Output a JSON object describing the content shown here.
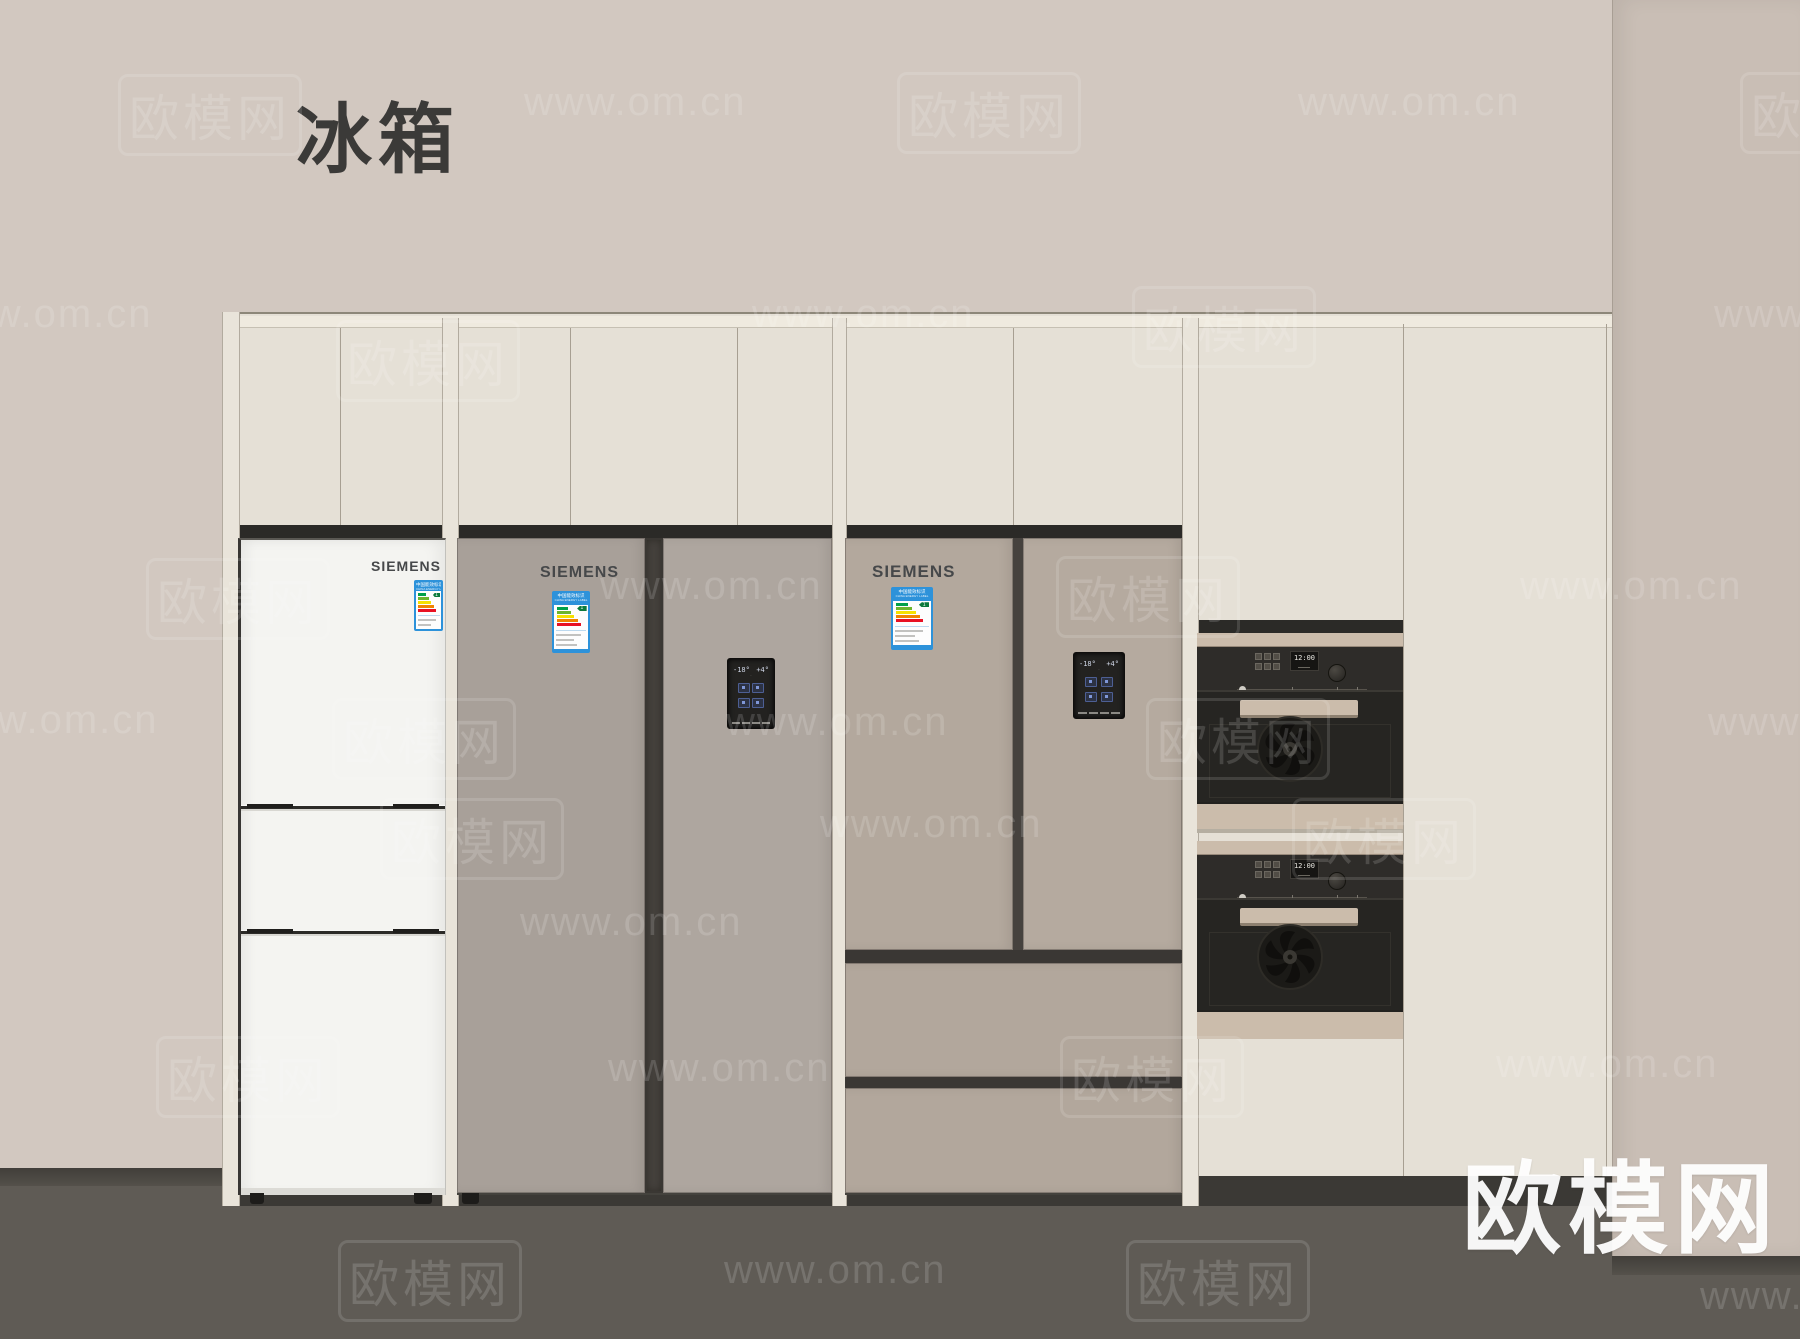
{
  "title": "冰箱",
  "site_logo": "欧模网",
  "watermark_url": "www.om.cn",
  "watermark_brand": "欧模网",
  "colors": {
    "wall": "#d2c8c0",
    "right_wall": "#c9beb5",
    "floor": "#5f5b55",
    "cabinet": "#e5e0d6",
    "fridge_white": "#f4f4f1",
    "fridge_gray": "#a8a099",
    "fridge_taupe": "#b3a89d",
    "label_blue": "#2d92da",
    "oven_trim": "#cbbcab",
    "oven_black": "#2e2c29"
  },
  "fridges": [
    {
      "brand": "SIEMENS",
      "type": "three-door bottom freezer"
    },
    {
      "brand": "SIEMENS",
      "type": "side-by-side",
      "panel": {
        "left_temp": "-18°",
        "right_temp": "+4°"
      }
    },
    {
      "brand": "SIEMENS",
      "type": "french-door with two drawers",
      "panel": {
        "left_temp": "-18°",
        "right_temp": "+4°"
      }
    }
  ],
  "energy_label": {
    "title": "中国能效标识",
    "subtitle": "CHINA ENERGY LABEL",
    "grade": "1"
  },
  "ovens": [
    {
      "display_time": "12:00"
    },
    {
      "display_time": "12:00"
    }
  ],
  "watermarks": [
    {
      "x": 118,
      "y": 74,
      "kind": "brand"
    },
    {
      "x": 524,
      "y": 80,
      "kind": "url"
    },
    {
      "x": 897,
      "y": 72,
      "kind": "brand"
    },
    {
      "x": 1298,
      "y": 80,
      "kind": "url"
    },
    {
      "x": 1740,
      "y": 72,
      "kind": "brand"
    },
    {
      "x": -70,
      "y": 292,
      "kind": "url"
    },
    {
      "x": 336,
      "y": 320,
      "kind": "brand"
    },
    {
      "x": 752,
      "y": 292,
      "kind": "url"
    },
    {
      "x": 1132,
      "y": 286,
      "kind": "brand"
    },
    {
      "x": 1714,
      "y": 292,
      "kind": "url"
    },
    {
      "x": 146,
      "y": 558,
      "kind": "brand"
    },
    {
      "x": 600,
      "y": 564,
      "kind": "url"
    },
    {
      "x": 1056,
      "y": 556,
      "kind": "brand"
    },
    {
      "x": 1520,
      "y": 564,
      "kind": "url"
    },
    {
      "x": -64,
      "y": 698,
      "kind": "url"
    },
    {
      "x": 332,
      "y": 698,
      "kind": "brand"
    },
    {
      "x": 726,
      "y": 700,
      "kind": "url"
    },
    {
      "x": 1146,
      "y": 698,
      "kind": "brand"
    },
    {
      "x": 1708,
      "y": 700,
      "kind": "url"
    },
    {
      "x": 380,
      "y": 798,
      "kind": "brand"
    },
    {
      "x": 820,
      "y": 802,
      "kind": "url"
    },
    {
      "x": 1292,
      "y": 798,
      "kind": "brand"
    },
    {
      "x": 520,
      "y": 900,
      "kind": "url"
    },
    {
      "x": 156,
      "y": 1036,
      "kind": "brand"
    },
    {
      "x": 608,
      "y": 1046,
      "kind": "url"
    },
    {
      "x": 1060,
      "y": 1036,
      "kind": "brand"
    },
    {
      "x": 1496,
      "y": 1042,
      "kind": "url"
    },
    {
      "x": 338,
      "y": 1240,
      "kind": "brand"
    },
    {
      "x": 724,
      "y": 1248,
      "kind": "url"
    },
    {
      "x": 1126,
      "y": 1240,
      "kind": "brand"
    },
    {
      "x": 1700,
      "y": 1274,
      "kind": "url"
    }
  ]
}
